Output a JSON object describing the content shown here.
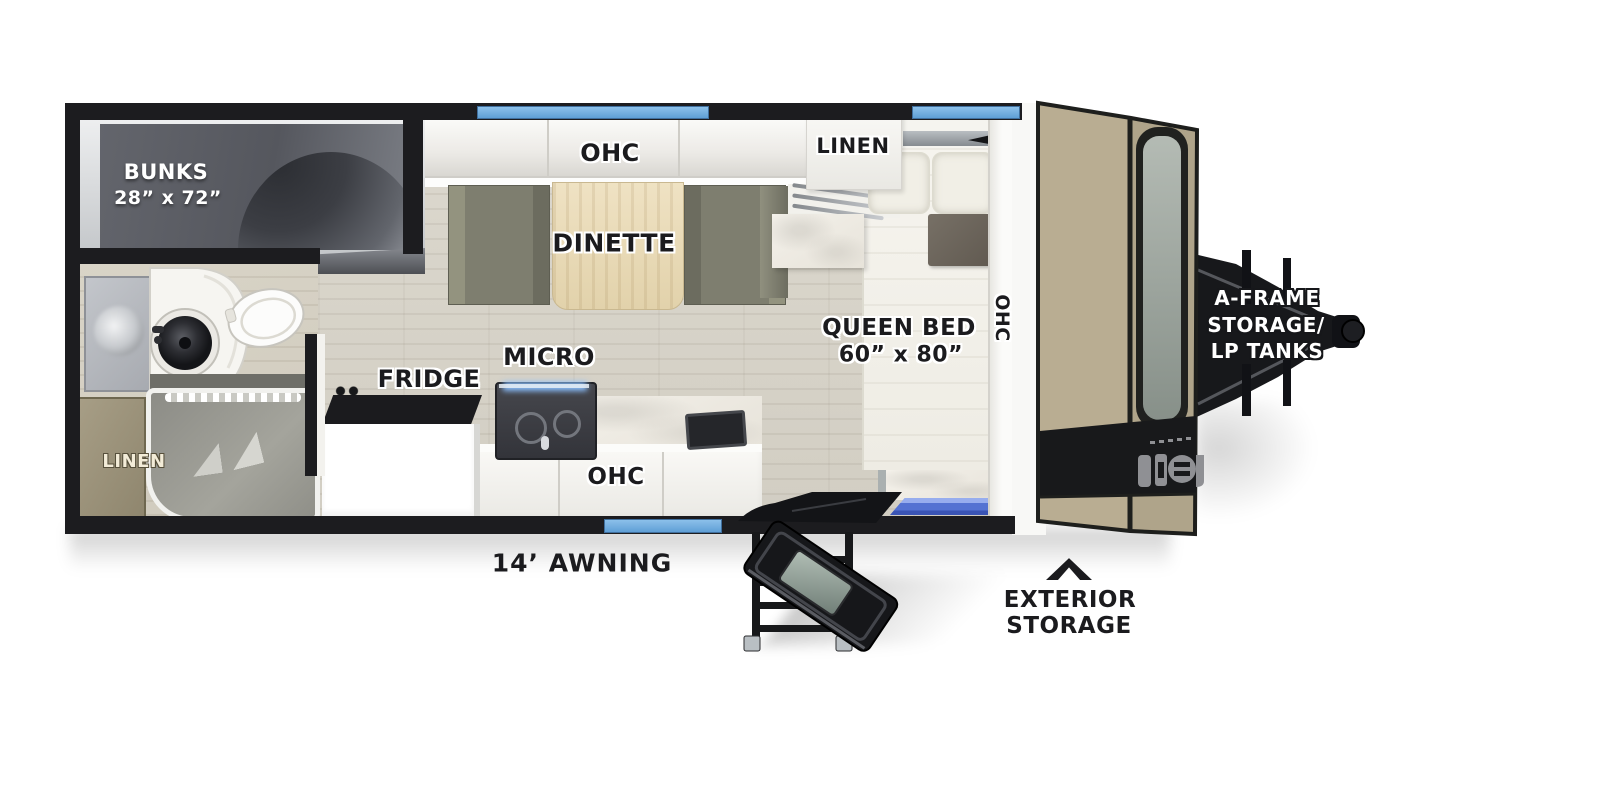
{
  "diagram": {
    "type": "rv-travel-trailer-floorplan",
    "labels": {
      "bunks": "BUNKS",
      "bunks_dims": "28” x 72”",
      "linen_bath": "LINEN",
      "ohc_dinette": "OHC",
      "dinette": "DINETTE",
      "linen_bedroom": "LINEN",
      "queen_bed": "QUEEN BED",
      "queen_bed_dims": "60” x 80”",
      "ohc_bedroom": "OHC",
      "fridge": "FRIDGE",
      "micro": "MICRO",
      "ohc_kitchen": "OHC",
      "awning": "14’ AWNING",
      "exterior_storage_line1": "EXTERIOR",
      "exterior_storage_line2": "STORAGE",
      "aframe_line1": "A-FRAME",
      "aframe_line2": "STORAGE/",
      "aframe_line3": "LP TANKS"
    },
    "colors": {
      "wall_black": "#1c1c1f",
      "window_blue": "#74b2e4",
      "front_cap_tan": "#b7ab90",
      "bench_olive": "#84846f",
      "linen_cabinet_tan": "#9a9178",
      "step_mat_blue": "#5472d2",
      "bunk_panel_gray": "#5a5c63",
      "table_wood": "#e8dab6"
    }
  }
}
